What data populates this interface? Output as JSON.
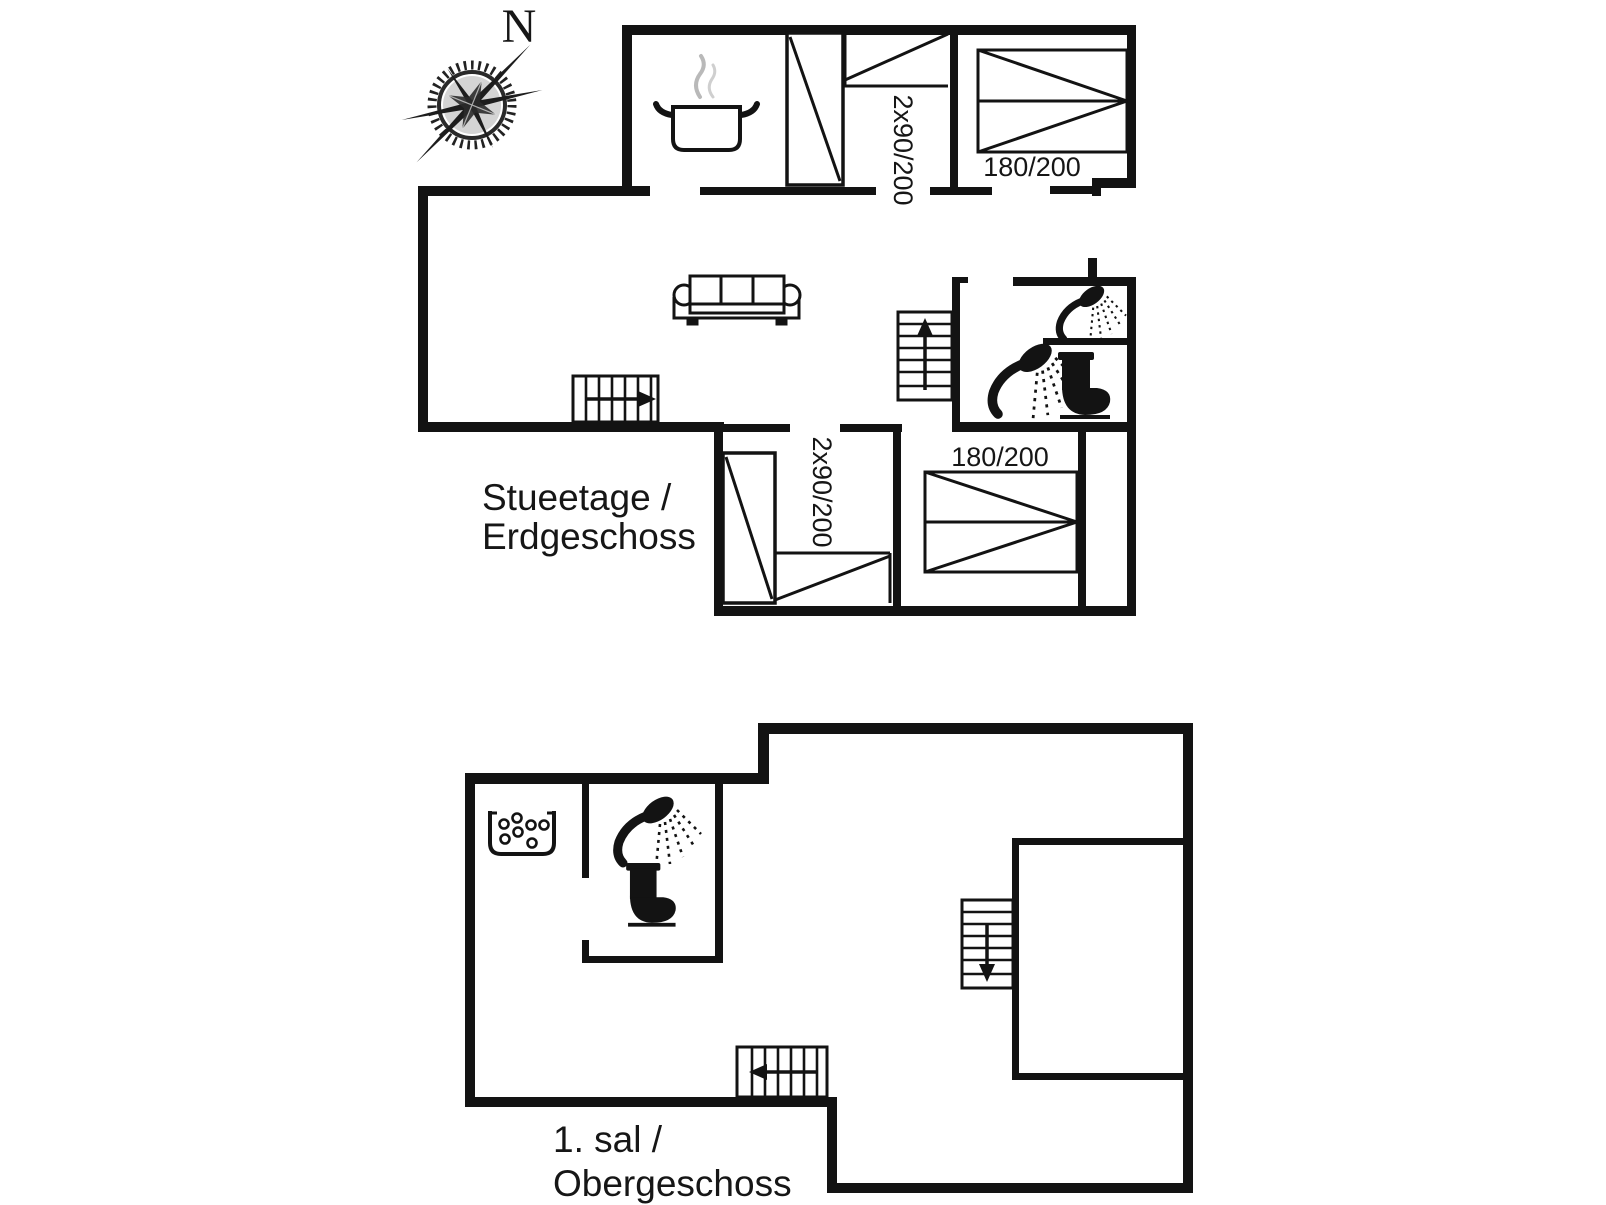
{
  "canvas": {
    "width": 1606,
    "height": 1205,
    "background": "#ffffff",
    "ink": "#131313",
    "steam_gray": "#b9b9b9"
  },
  "compass": {
    "label": "N",
    "name": "compass-rose"
  },
  "floors": [
    {
      "name": "ground-floor",
      "label": [
        "Stueetage /",
        "Erdgeschoss"
      ],
      "beds": [
        {
          "id": "double-bed-top",
          "label": "2x90/200",
          "orientation": "vertical"
        },
        {
          "id": "single-bed-top",
          "label": "180/200",
          "orientation": "horizontal"
        },
        {
          "id": "double-bed-bottom",
          "label": "2x90/200",
          "orientation": "vertical"
        },
        {
          "id": "single-bed-bottom",
          "label": "180/200",
          "orientation": "horizontal"
        }
      ],
      "fixtures": [
        "cooking-pot",
        "wardrobe",
        "wardrobe",
        "sofa",
        "stairs-right-arrow",
        "stairs-up-arrow",
        "shower-head",
        "shower-head",
        "toilet"
      ]
    },
    {
      "name": "upper-floor",
      "label": [
        "1. sal /",
        "Obergeschoss"
      ],
      "beds": [],
      "fixtures": [
        "whirlpool-tub",
        "shower-head",
        "toilet",
        "stairs-down-arrow",
        "stairs-left-arrow"
      ]
    }
  ]
}
